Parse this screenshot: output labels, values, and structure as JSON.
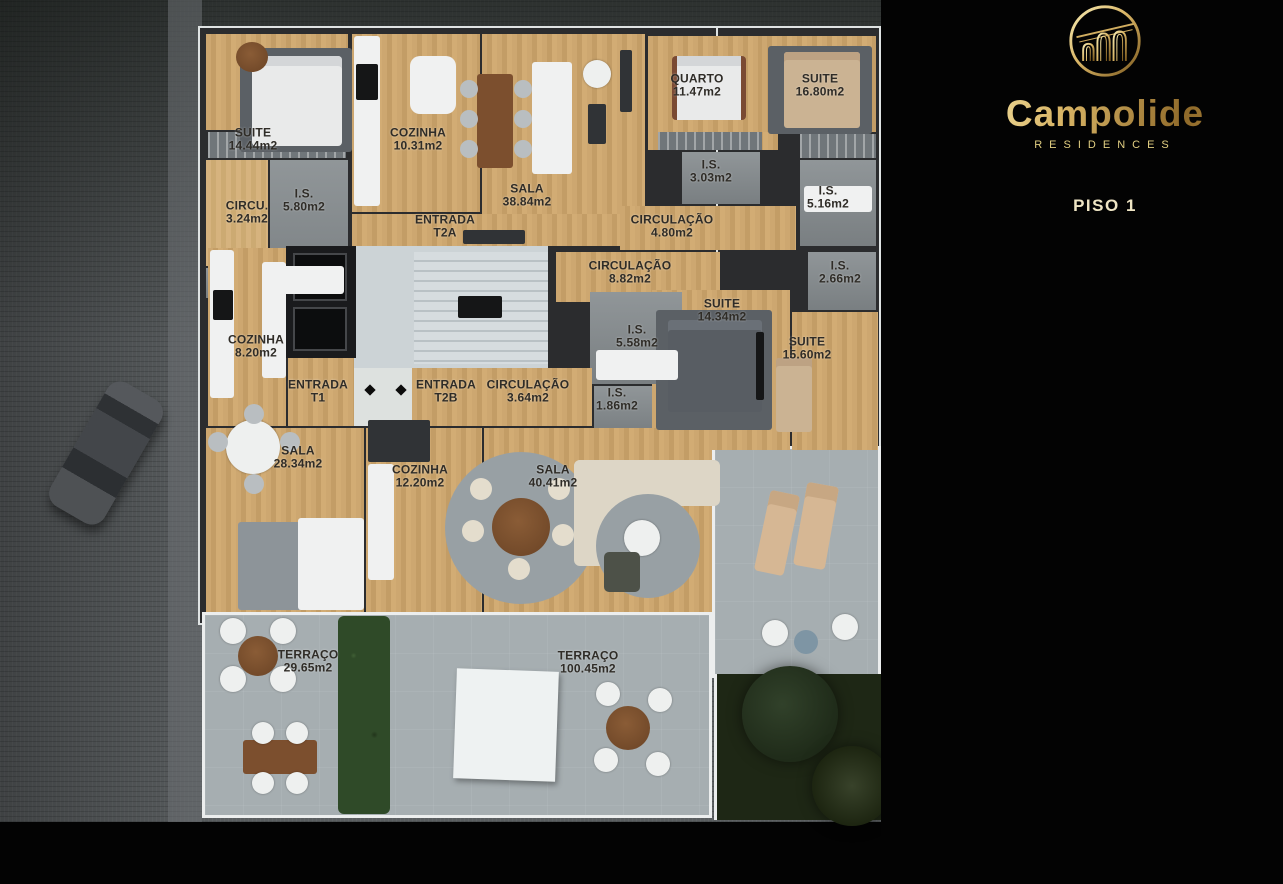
{
  "brand": {
    "name": "Campolide",
    "subtitle": "RESIDENCES",
    "logo": "aqueduct-arches-emblem"
  },
  "page": {
    "floor_title": "PISO 1",
    "footnote": "*ABC :  ÁREA APARTAMENTO + VARANDAS + ARRECADAÇÃO"
  },
  "colors": {
    "gold": "#e8d584",
    "gold_bright": "#f3e4a6",
    "gold_deep": "#8f6a2a",
    "panel_bg": "#030303",
    "plan_wall": "#2b2c2e",
    "wood_floor": "#c9a26b",
    "bath_tile": "#8a9094",
    "terrace": "#a6aeb1",
    "street": "#5a5e60",
    "garden": "#1e2715",
    "label_ink": "#2f2c27"
  },
  "units": [
    {
      "badge_code": "T2",
      "badge_variant": "A",
      "rows": [
        {
          "icon": "floorplan-icon",
          "text": "ÁREA DE CONSTRUÇÃO BRUTA :  112.85 m2*"
        },
        {
          "icon": "bed-icon",
          "text": "1 QUARTO + 1 SUITE"
        },
        {
          "icon": "shower-icon",
          "text": "2 INSTALAÇÕES SANITÁRIAS"
        },
        {
          "icon": "garage-icon",
          "text": "2 LUGARES ESTACIONAMENTO"
        }
      ]
    },
    {
      "badge_code": "T2",
      "badge_variant": "B",
      "rows": [
        {
          "icon": "floorplan-icon",
          "text": "ÁREA DE CONSTRUÇÃO BRUTA :  240.55 m2*"
        },
        {
          "icon": "bed-icon",
          "text": "2 SUITES"
        },
        {
          "icon": "shower-icon",
          "text": "3 INSTALAÇÕES SANITÁRIAS"
        },
        {
          "icon": "garage-icon",
          "text": "2 LUGARES ESTACIONAMENTO"
        }
      ]
    },
    {
      "badge_code": "T1",
      "badge_variant": "",
      "rows": [
        {
          "icon": "floorplan-icon",
          "text": "ÁREA DE CONSTRUÇÃO BRUTA :  110.70m2*"
        },
        {
          "icon": "bed-icon",
          "text": "1 SUITE"
        },
        {
          "icon": "shower-icon",
          "text": "1 INSTALAÇÃO SANITÁRIA"
        },
        {
          "icon": "garage-icon",
          "text": "2 LUGARES ESTACIONAMENTO"
        }
      ]
    }
  ],
  "floorplan": {
    "rooms": [
      {
        "label": "SUITE",
        "area": "14.44m2",
        "x": 253,
        "y": 140
      },
      {
        "label": "COZINHA",
        "area": "10.31m2",
        "x": 418,
        "y": 140
      },
      {
        "label": "SALA",
        "area": "38.84m2",
        "x": 527,
        "y": 196
      },
      {
        "label": "QUARTO",
        "area": "11.47m2",
        "x": 697,
        "y": 86
      },
      {
        "label": "SUITE",
        "area": "16.80m2",
        "x": 820,
        "y": 86
      },
      {
        "label": "I.S.",
        "area": "3.03m2",
        "x": 711,
        "y": 172
      },
      {
        "label": "I.S.",
        "area": "5.80m2",
        "x": 304,
        "y": 201
      },
      {
        "label": "CIRCU.",
        "area": "3.24m2",
        "x": 247,
        "y": 213
      },
      {
        "label": "I.S.",
        "area": "5.16m2",
        "x": 828,
        "y": 198
      },
      {
        "label": "CIRCULAÇÃO",
        "area": "4.80m2",
        "x": 672,
        "y": 227
      },
      {
        "label": "ENTRADA",
        "area": "T2A",
        "x": 445,
        "y": 227
      },
      {
        "label": "CIRCULAÇÃO",
        "area": "8.82m2",
        "x": 630,
        "y": 273
      },
      {
        "label": "I.S.",
        "area": "2.66m2",
        "x": 840,
        "y": 273
      },
      {
        "label": "SUITE",
        "area": "14.34m2",
        "x": 722,
        "y": 311
      },
      {
        "label": "I.S.",
        "area": "5.58m2",
        "x": 637,
        "y": 337
      },
      {
        "label": "SUITE",
        "area": "15.60m2",
        "x": 807,
        "y": 349
      },
      {
        "label": "COZINHA",
        "area": "8.20m2",
        "x": 256,
        "y": 347
      },
      {
        "label": "ENTRADA",
        "area": "T1",
        "x": 318,
        "y": 392
      },
      {
        "label": "ENTRADA",
        "area": "T2B",
        "x": 446,
        "y": 392
      },
      {
        "label": "CIRCULAÇÃO",
        "area": "3.64m2",
        "x": 528,
        "y": 392
      },
      {
        "label": "I.S.",
        "area": "1.86m2",
        "x": 617,
        "y": 400
      },
      {
        "label": "SALA",
        "area": "28.34m2",
        "x": 298,
        "y": 458
      },
      {
        "label": "COZINHA",
        "area": "12.20m2",
        "x": 420,
        "y": 477
      },
      {
        "label": "SALA",
        "area": "40.41m2",
        "x": 553,
        "y": 477
      },
      {
        "label": "TERRAÇO",
        "area": "29.65m2",
        "x": 308,
        "y": 662
      },
      {
        "label": "TERRAÇO",
        "area": "100.45m2",
        "x": 588,
        "y": 663
      }
    ]
  }
}
